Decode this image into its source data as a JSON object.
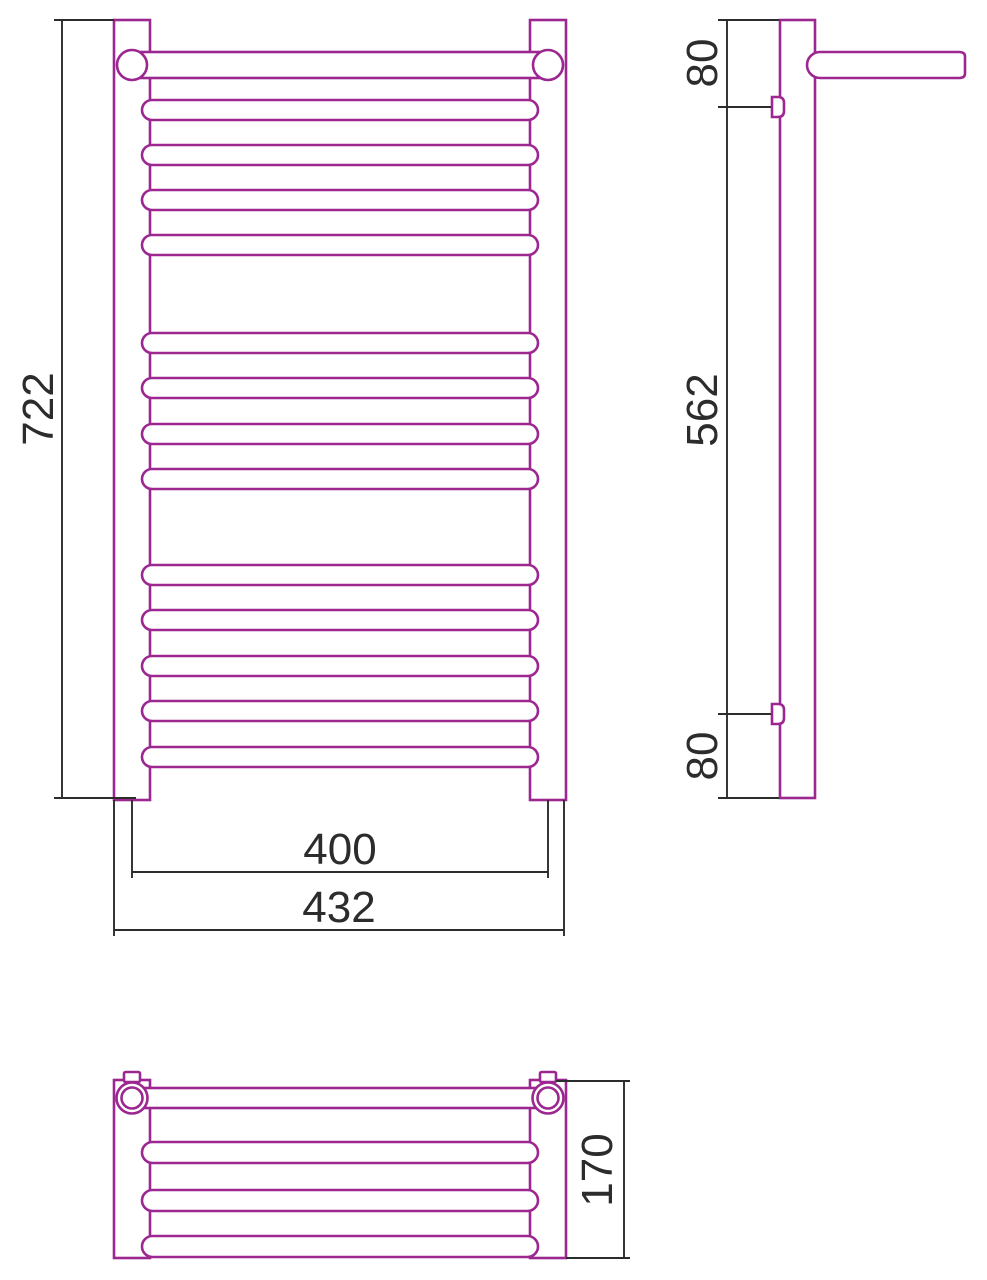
{
  "document": {
    "description": "Dimensioned technical drawing of a ladder-style towel radiator with a top shelf: front view, side view and top view"
  },
  "colors": {
    "outline": "#9c2790",
    "dimension": "#2c2c2c",
    "background": "#ffffff"
  },
  "front_view": {
    "height": "722",
    "rail_span": "400",
    "overall_width": "432",
    "rung_count": 13
  },
  "side_view": {
    "top_to_upper_bracket": "80",
    "bracket_to_bracket": "562",
    "lower_bracket_to_bottom": "80"
  },
  "top_view": {
    "depth": "170",
    "shelf_bar_count": 4
  }
}
